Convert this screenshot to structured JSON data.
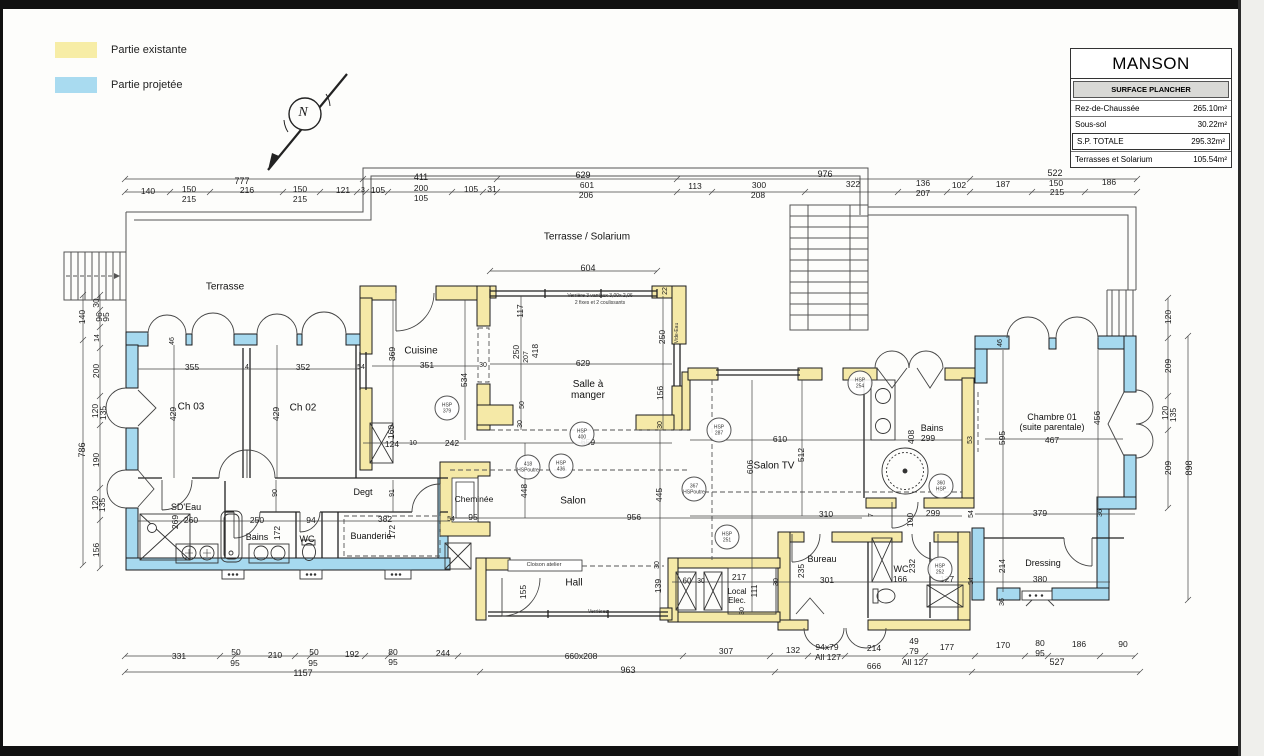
{
  "legend": {
    "items": [
      {
        "label": "Partie existante",
        "color": "#f7eda6"
      },
      {
        "label": "Partie projetée",
        "color": "#a9dbf0"
      }
    ]
  },
  "titleblock": {
    "title": "MANSON",
    "header": "SURFACE PLANCHER",
    "rows": [
      {
        "label": "Rez-de-Chaussée",
        "value": "265.10m²"
      },
      {
        "label": "Sous-sol",
        "value": "30.22m²"
      },
      {
        "label": "S.P. TOTALE",
        "value": "295.32m²"
      },
      {
        "label": "Terrasses et Solarium",
        "value": "105.54m²"
      }
    ]
  },
  "colors": {
    "existing": "#f5e9a7",
    "projected": "#a6d9ef",
    "wall_stroke": "#1c1c1c",
    "dim_line": "#444444"
  },
  "plan": {
    "label_fields": [
      "text",
      "x",
      "y",
      "rotated",
      "size",
      "kind"
    ],
    "labels": [
      [
        "N",
        303,
        113,
        0,
        0,
        "n"
      ],
      [
        "Terrasse",
        225,
        287,
        0,
        0,
        "room"
      ],
      [
        "Terrasse / Solarium",
        587,
        237,
        0,
        0,
        "room"
      ],
      [
        "Ch 03",
        191,
        407,
        0,
        0,
        "room"
      ],
      [
        "Ch 02",
        303,
        408,
        0,
        0,
        "room"
      ],
      [
        "Cuisine",
        421,
        351,
        0,
        0,
        "room"
      ],
      [
        "Salle à\nmanger",
        588,
        390,
        0,
        0,
        "room"
      ],
      [
        "Salon",
        573,
        501,
        0,
        0,
        "room"
      ],
      [
        "Salon TV",
        774,
        466,
        0,
        0,
        "room"
      ],
      [
        "Bains",
        932,
        428,
        0,
        9,
        "room"
      ],
      [
        "Chambre 01\n(suite parentale)",
        1052,
        422,
        0,
        9,
        "room"
      ],
      [
        "SD'Eau",
        186,
        507,
        0,
        9,
        "room"
      ],
      [
        "Bains",
        257,
        537,
        0,
        9,
        "room"
      ],
      [
        "WC",
        307,
        539,
        0,
        9,
        "room"
      ],
      [
        "Degt",
        363,
        492,
        0,
        9,
        "room"
      ],
      [
        "Buanderie",
        371,
        536,
        0,
        9,
        "room"
      ],
      [
        "Cheminée",
        474,
        500,
        0,
        8.5,
        "room"
      ],
      [
        "Hall",
        574,
        583,
        0,
        0,
        "room"
      ],
      [
        "Local\nElec.",
        737,
        597,
        0,
        8,
        "room"
      ],
      [
        "Bureau",
        822,
        559,
        0,
        9,
        "room"
      ],
      [
        "WC",
        901,
        569,
        0,
        9,
        "room"
      ],
      [
        "Dressing",
        1043,
        563,
        0,
        9,
        "room"
      ],
      [
        "777",
        242,
        181,
        0,
        9
      ],
      [
        "411",
        421,
        177,
        0,
        9
      ],
      [
        "629",
        583,
        175,
        0,
        9
      ],
      [
        "976",
        825,
        174,
        0,
        9
      ],
      [
        "522",
        1055,
        173,
        0,
        9
      ],
      [
        "140",
        148,
        192,
        0,
        0
      ],
      [
        "150",
        189,
        190,
        0,
        0
      ],
      [
        "215",
        189,
        200,
        0,
        0
      ],
      [
        "216",
        247,
        191,
        0,
        0
      ],
      [
        "150",
        300,
        190,
        0,
        0
      ],
      [
        "215",
        300,
        200,
        0,
        0
      ],
      [
        "121",
        343,
        191,
        0,
        0
      ],
      [
        "3",
        363,
        191,
        0,
        7
      ],
      [
        "105",
        378,
        191,
        0,
        0
      ],
      [
        "200",
        421,
        189,
        0,
        0
      ],
      [
        "105",
        421,
        199,
        0,
        0
      ],
      [
        "105",
        471,
        190,
        0,
        0
      ],
      [
        "31",
        492,
        190,
        0,
        0
      ],
      [
        "601",
        587,
        186,
        0,
        0
      ],
      [
        "206",
        586,
        196,
        0,
        0
      ],
      [
        "113",
        695,
        187,
        0,
        0
      ],
      [
        "300",
        759,
        186,
        0,
        0
      ],
      [
        "208",
        758,
        196,
        0,
        0
      ],
      [
        "322",
        853,
        185,
        0,
        0
      ],
      [
        "136",
        923,
        184,
        0,
        0
      ],
      [
        "207",
        923,
        194,
        0,
        0
      ],
      [
        "102",
        959,
        186,
        0,
        0
      ],
      [
        "187",
        1003,
        185,
        0,
        0
      ],
      [
        "150",
        1056,
        184,
        0,
        0
      ],
      [
        "215",
        1057,
        193,
        0,
        0
      ],
      [
        "186",
        1109,
        183,
        0,
        0
      ],
      [
        "331",
        179,
        657,
        0,
        0
      ],
      [
        "50",
        236,
        653,
        0,
        0
      ],
      [
        "95",
        235,
        664,
        0,
        0
      ],
      [
        "210",
        275,
        656,
        0,
        0
      ],
      [
        "50",
        314,
        653,
        0,
        0
      ],
      [
        "95",
        313,
        664,
        0,
        0
      ],
      [
        "192",
        352,
        655,
        0,
        0
      ],
      [
        "80",
        393,
        653,
        0,
        0
      ],
      [
        "95",
        393,
        663,
        0,
        0
      ],
      [
        "244",
        443,
        654,
        0,
        0
      ],
      [
        "1157",
        303,
        673,
        0,
        9
      ],
      [
        "660x208",
        581,
        657,
        0,
        0
      ],
      [
        "307",
        726,
        652,
        0,
        0
      ],
      [
        "132",
        793,
        651,
        0,
        0
      ],
      [
        "94x79",
        827,
        648,
        0,
        0
      ],
      [
        "All 127",
        828,
        658,
        0,
        0
      ],
      [
        "214",
        874,
        649,
        0,
        0
      ],
      [
        "49",
        914,
        642,
        0,
        0
      ],
      [
        "79",
        914,
        652,
        0,
        0
      ],
      [
        "All 127",
        915,
        663,
        0,
        0
      ],
      [
        "963",
        628,
        670,
        0,
        9
      ],
      [
        "666",
        874,
        667,
        0,
        0
      ],
      [
        "177",
        947,
        648,
        0,
        0
      ],
      [
        "170",
        1003,
        646,
        0,
        0
      ],
      [
        "80",
        1040,
        644,
        0,
        0
      ],
      [
        "95",
        1040,
        654,
        0,
        0
      ],
      [
        "186",
        1079,
        645,
        0,
        0
      ],
      [
        "90",
        1123,
        645,
        0,
        0
      ],
      [
        "527",
        1057,
        662,
        0,
        9
      ],
      [
        "30",
        97,
        303,
        1,
        0
      ],
      [
        "140",
        83,
        317,
        1,
        0
      ],
      [
        "96",
        100,
        317,
        1,
        0
      ],
      [
        "95",
        107,
        317,
        1,
        0
      ],
      [
        "14",
        98,
        338,
        1,
        7
      ],
      [
        "200",
        97,
        371,
        1,
        0
      ],
      [
        "120",
        96,
        411,
        1,
        0
      ],
      [
        "135",
        104,
        413,
        1,
        0
      ],
      [
        "190",
        97,
        460,
        1,
        0
      ],
      [
        "120",
        96,
        503,
        1,
        0
      ],
      [
        "135",
        103,
        505,
        1,
        0
      ],
      [
        "156",
        97,
        550,
        1,
        0
      ],
      [
        "786",
        82,
        450,
        1,
        9
      ],
      [
        "120",
        1169,
        317,
        1,
        0
      ],
      [
        "209",
        1169,
        366,
        1,
        0
      ],
      [
        "120",
        1166,
        413,
        1,
        0
      ],
      [
        "135",
        1174,
        415,
        1,
        0
      ],
      [
        "209",
        1169,
        468,
        1,
        0
      ],
      [
        "898",
        1189,
        468,
        1,
        9
      ],
      [
        "604",
        588,
        268,
        0,
        9
      ],
      [
        "355",
        192,
        368,
        0,
        0
      ],
      [
        "4",
        247,
        368,
        0,
        7
      ],
      [
        "352",
        303,
        368,
        0,
        0
      ],
      [
        "54",
        361,
        368,
        0,
        7
      ],
      [
        "429",
        174,
        414,
        1,
        0
      ],
      [
        "429",
        277,
        414,
        1,
        0
      ],
      [
        "46",
        173,
        341,
        1,
        7
      ],
      [
        "369",
        393,
        354,
        1,
        0
      ],
      [
        "351",
        427,
        366,
        0,
        0
      ],
      [
        "30",
        483,
        366,
        0,
        7
      ],
      [
        "534",
        465,
        380,
        1,
        0
      ],
      [
        "117",
        521,
        311,
        1,
        0
      ],
      [
        "250",
        517,
        352,
        1,
        0
      ],
      [
        "207",
        527,
        357,
        1,
        7
      ],
      [
        "418",
        536,
        351,
        1,
        0
      ],
      [
        "629",
        583,
        364,
        0,
        0
      ],
      [
        "250",
        663,
        337,
        1,
        0
      ],
      [
        "22",
        666,
        291,
        1,
        7
      ],
      [
        "156",
        661,
        393,
        1,
        0
      ],
      [
        "30",
        661,
        425,
        1,
        7
      ],
      [
        "50",
        523,
        405,
        1,
        7
      ],
      [
        "30",
        521,
        424,
        1,
        7
      ],
      [
        "160",
        392,
        432,
        1,
        0
      ],
      [
        "124",
        392,
        445,
        0,
        0
      ],
      [
        "10",
        413,
        444,
        0,
        7
      ],
      [
        "242",
        452,
        444,
        0,
        0
      ],
      [
        "659",
        588,
        443,
        0,
        0
      ],
      [
        "90",
        276,
        493,
        1,
        7
      ],
      [
        "91",
        393,
        493,
        1,
        7
      ],
      [
        "269",
        176,
        522,
        1,
        0
      ],
      [
        "260",
        191,
        521,
        0,
        0
      ],
      [
        "250",
        257,
        521,
        0,
        0
      ],
      [
        "172",
        278,
        533,
        1,
        0
      ],
      [
        "94",
        311,
        521,
        0,
        0
      ],
      [
        "382",
        385,
        520,
        0,
        0
      ],
      [
        "172",
        393,
        532,
        1,
        0
      ],
      [
        "54",
        451,
        520,
        0,
        7
      ],
      [
        "95",
        473,
        518,
        0,
        0
      ],
      [
        "448",
        525,
        491,
        1,
        0
      ],
      [
        "956",
        634,
        518,
        0,
        0
      ],
      [
        "445",
        660,
        495,
        1,
        0
      ],
      [
        "155",
        524,
        592,
        1,
        0
      ],
      [
        "139",
        659,
        586,
        1,
        0
      ],
      [
        "30",
        658,
        565,
        1,
        7
      ],
      [
        "60",
        687,
        582,
        0,
        8
      ],
      [
        "30",
        701,
        582,
        0,
        7
      ],
      [
        "217",
        739,
        578,
        0,
        0
      ],
      [
        "111",
        755,
        591,
        1,
        0
      ],
      [
        "30",
        743,
        611,
        1,
        7
      ],
      [
        "30",
        777,
        582,
        1,
        7
      ],
      [
        "606",
        751,
        467,
        1,
        0
      ],
      [
        "610",
        780,
        440,
        0,
        0
      ],
      [
        "512",
        802,
        455,
        1,
        0
      ],
      [
        "310",
        826,
        515,
        0,
        0
      ],
      [
        "7",
        872,
        515,
        1,
        7
      ],
      [
        "100",
        911,
        520,
        1,
        0
      ],
      [
        "299",
        933,
        514,
        0,
        0
      ],
      [
        "408",
        912,
        437,
        1,
        0
      ],
      [
        "299",
        928,
        439,
        0,
        0
      ],
      [
        "53",
        971,
        440,
        1,
        7
      ],
      [
        "54",
        972,
        514,
        1,
        7
      ],
      [
        "235",
        802,
        571,
        1,
        0
      ],
      [
        "301",
        827,
        581,
        0,
        0
      ],
      [
        "232",
        913,
        566,
        1,
        0
      ],
      [
        "166",
        900,
        580,
        0,
        0
      ],
      [
        "127",
        947,
        580,
        0,
        0
      ],
      [
        "54",
        972,
        581,
        1,
        7
      ],
      [
        "214",
        1003,
        566,
        1,
        0
      ],
      [
        "380",
        1040,
        580,
        0,
        0
      ],
      [
        "36",
        1003,
        602,
        1,
        7
      ],
      [
        "595",
        1003,
        438,
        1,
        0
      ],
      [
        "467",
        1052,
        441,
        0,
        0
      ],
      [
        "456",
        1098,
        418,
        1,
        0
      ],
      [
        "379",
        1040,
        514,
        0,
        0
      ],
      [
        "36",
        1101,
        513,
        1,
        7
      ],
      [
        "46",
        1001,
        343,
        1,
        7
      ],
      [
        "Verrière 3 vantaux 3,00x 2,06",
        600,
        297,
        0,
        5,
        "note"
      ],
      [
        "2 fixes et 2 coulissants",
        600,
        304,
        0,
        5,
        "note"
      ],
      [
        "Vide-Eau",
        678,
        333,
        1,
        5,
        "note"
      ],
      [
        "Cloison atelier",
        544,
        565,
        0,
        5.5,
        "note"
      ],
      [
        "Verrières",
        598,
        613,
        0,
        5,
        "note"
      ]
    ],
    "hsp_badges": [
      {
        "x": 447,
        "y": 408,
        "t": "HSP\n379"
      },
      {
        "x": 528,
        "y": 467,
        "t": "418\nHSPoutre"
      },
      {
        "x": 561,
        "y": 466,
        "t": "HSP\n436"
      },
      {
        "x": 582,
        "y": 434,
        "t": "HSP\n400"
      },
      {
        "x": 694,
        "y": 489,
        "t": "367\nHSPoutre"
      },
      {
        "x": 727,
        "y": 537,
        "t": "HSP\n251"
      },
      {
        "x": 719,
        "y": 430,
        "t": "HSP\n287"
      },
      {
        "x": 860,
        "y": 383,
        "t": "HSP\n254"
      },
      {
        "x": 941,
        "y": 486,
        "t": "360\nHSP"
      },
      {
        "x": 940,
        "y": 569,
        "t": "HSP\n252"
      }
    ]
  }
}
